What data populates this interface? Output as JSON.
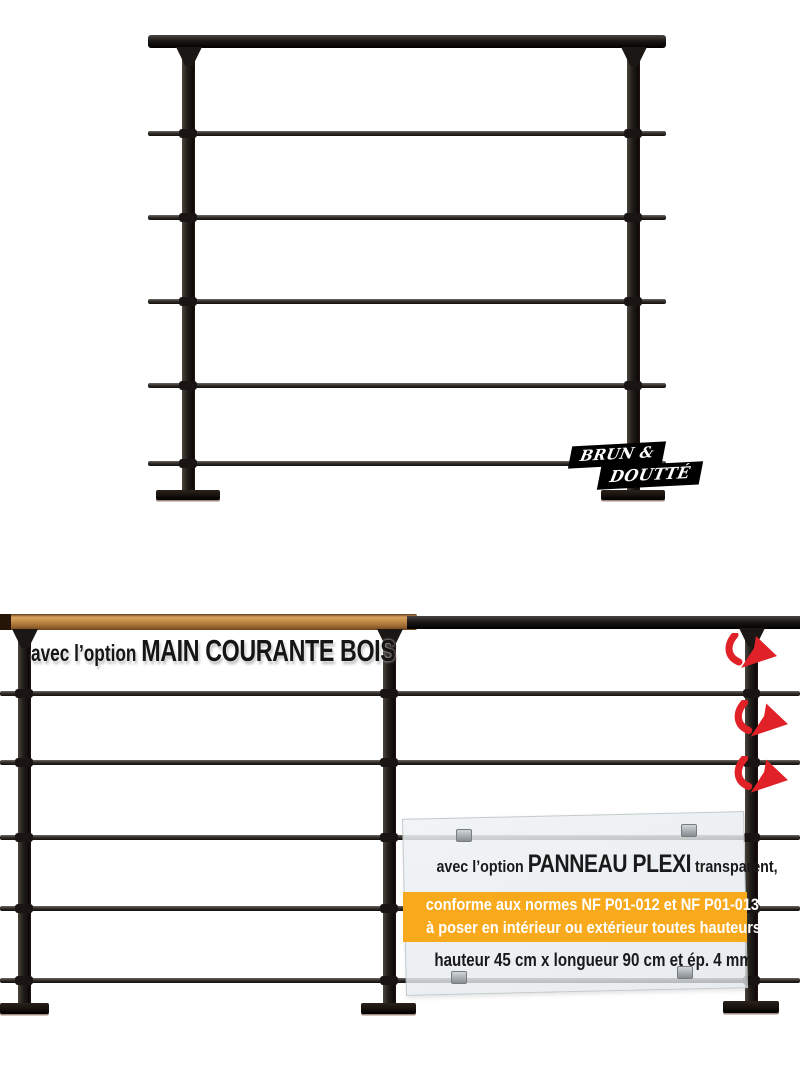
{
  "brand_badge": {
    "line1": "BRUN &",
    "line2": "DOUTTÉ"
  },
  "colors": {
    "accent_orange": "#F8A91C",
    "arrow_red": "#E02127",
    "metal_black": "#1D1B18",
    "wood_brown": "#B5763A",
    "plexi_panel_tint": "#E9EDEF"
  },
  "icons": {
    "snap_arrow": "curved-red-arrow"
  },
  "options": {
    "wood_handrail": {
      "prefix": "avec l’option ",
      "name": "MAIN COURANTE BOIS"
    },
    "plexi_panel": {
      "prefix": "avec l’option ",
      "name": "PANNEAU PLEXI",
      "suffix": " transparent,",
      "norms_line1": "conforme aux normes NF P01-012 et NF P01-013",
      "norms_line2": "à poser en intérieur ou extérieur toutes hauteurs.",
      "dimensions": "hauteur 45 cm x longueur 90 cm et ép. 4 mm"
    }
  }
}
